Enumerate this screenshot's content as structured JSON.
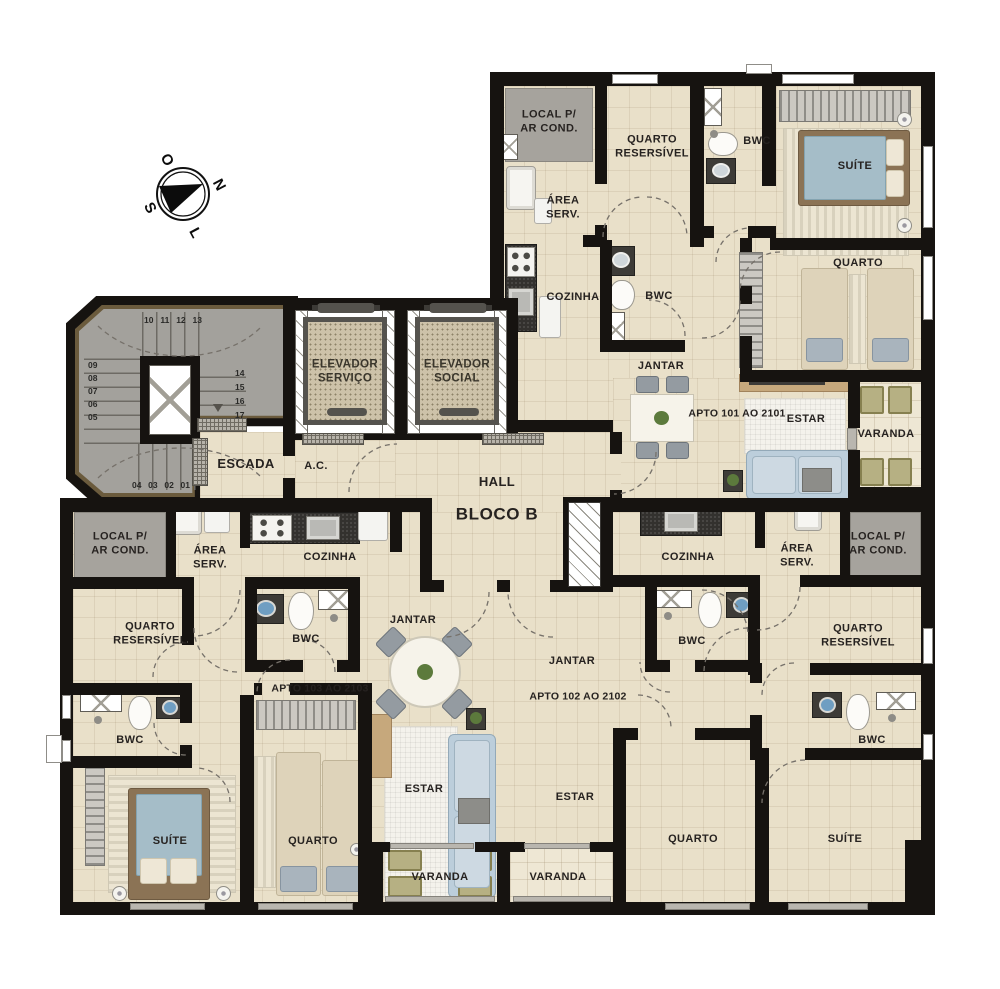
{
  "colors": {
    "wall": "#161310",
    "floor": "#e9e0c9",
    "floor_varanda": "#eee7d4",
    "gray_zone": "#a6a39d",
    "suite_mattress": "#a5bdc8",
    "sofa": "#bccedb",
    "varanda_chair": "#b6b083"
  },
  "compass": {
    "north": "N",
    "south": "S",
    "east": "L",
    "west": "O"
  },
  "core": {
    "hall_label": "HALL",
    "block_label": "BLOCO B",
    "stairs_label": "ESCADA",
    "ac_label": "A.C.",
    "elevator_service": "ELEVADOR\nSERVIÇO",
    "elevator_social": "ELEVADOR\nSOCIAL",
    "stair_steps": {
      "top": [
        "10",
        "11",
        "12",
        "13"
      ],
      "left": [
        "09",
        "08",
        "07",
        "06",
        "05"
      ],
      "right": [
        "14",
        "15",
        "16",
        "17"
      ],
      "bottom": [
        "04",
        "03",
        "02",
        "01"
      ]
    }
  },
  "apt101": {
    "id_label": "APTO 101 AO 2101",
    "local_ar_cond": "LOCAL P/\nAR COND.",
    "quarto_reversivel": "QUARTO\nRESERSÍVEL",
    "bwc_suite": "BWC",
    "suite": "SUÍTE",
    "area_servico": "ÁREA\nSERV.",
    "cozinha": "COZINHA",
    "bwc_social": "BWC",
    "quarto": "QUARTO",
    "jantar": "JANTAR",
    "estar": "ESTAR",
    "varanda": "VARANDA"
  },
  "apt102": {
    "id_label": "APTO 102 AO 2102",
    "local_ar_cond": "LOCAL P/\nAR COND.",
    "quarto_reversivel": "QUARTO\nRESERSÍVEL",
    "bwc_suite": "BWC",
    "suite": "SUÍTE",
    "area_servico": "ÁREA\nSERV.",
    "cozinha": "COZINHA",
    "bwc_social": "BWC",
    "quarto": "QUARTO",
    "jantar": "JANTAR",
    "estar": "ESTAR",
    "varanda": "VARANDA"
  },
  "apt103": {
    "id_label": "APTO 103 AO 2103",
    "local_ar_cond": "LOCAL P/\nAR COND.",
    "quarto_reversivel": "QUARTO\nRESERSÍVEL",
    "bwc_suite": "BWC",
    "suite": "SUÍTE",
    "area_servico": "ÁREA\nSERV.",
    "cozinha": "COZINHA",
    "bwc_social": "BWC",
    "quarto": "QUARTO",
    "jantar": "JANTAR",
    "estar": "ESTAR",
    "varanda": "VARANDA"
  }
}
